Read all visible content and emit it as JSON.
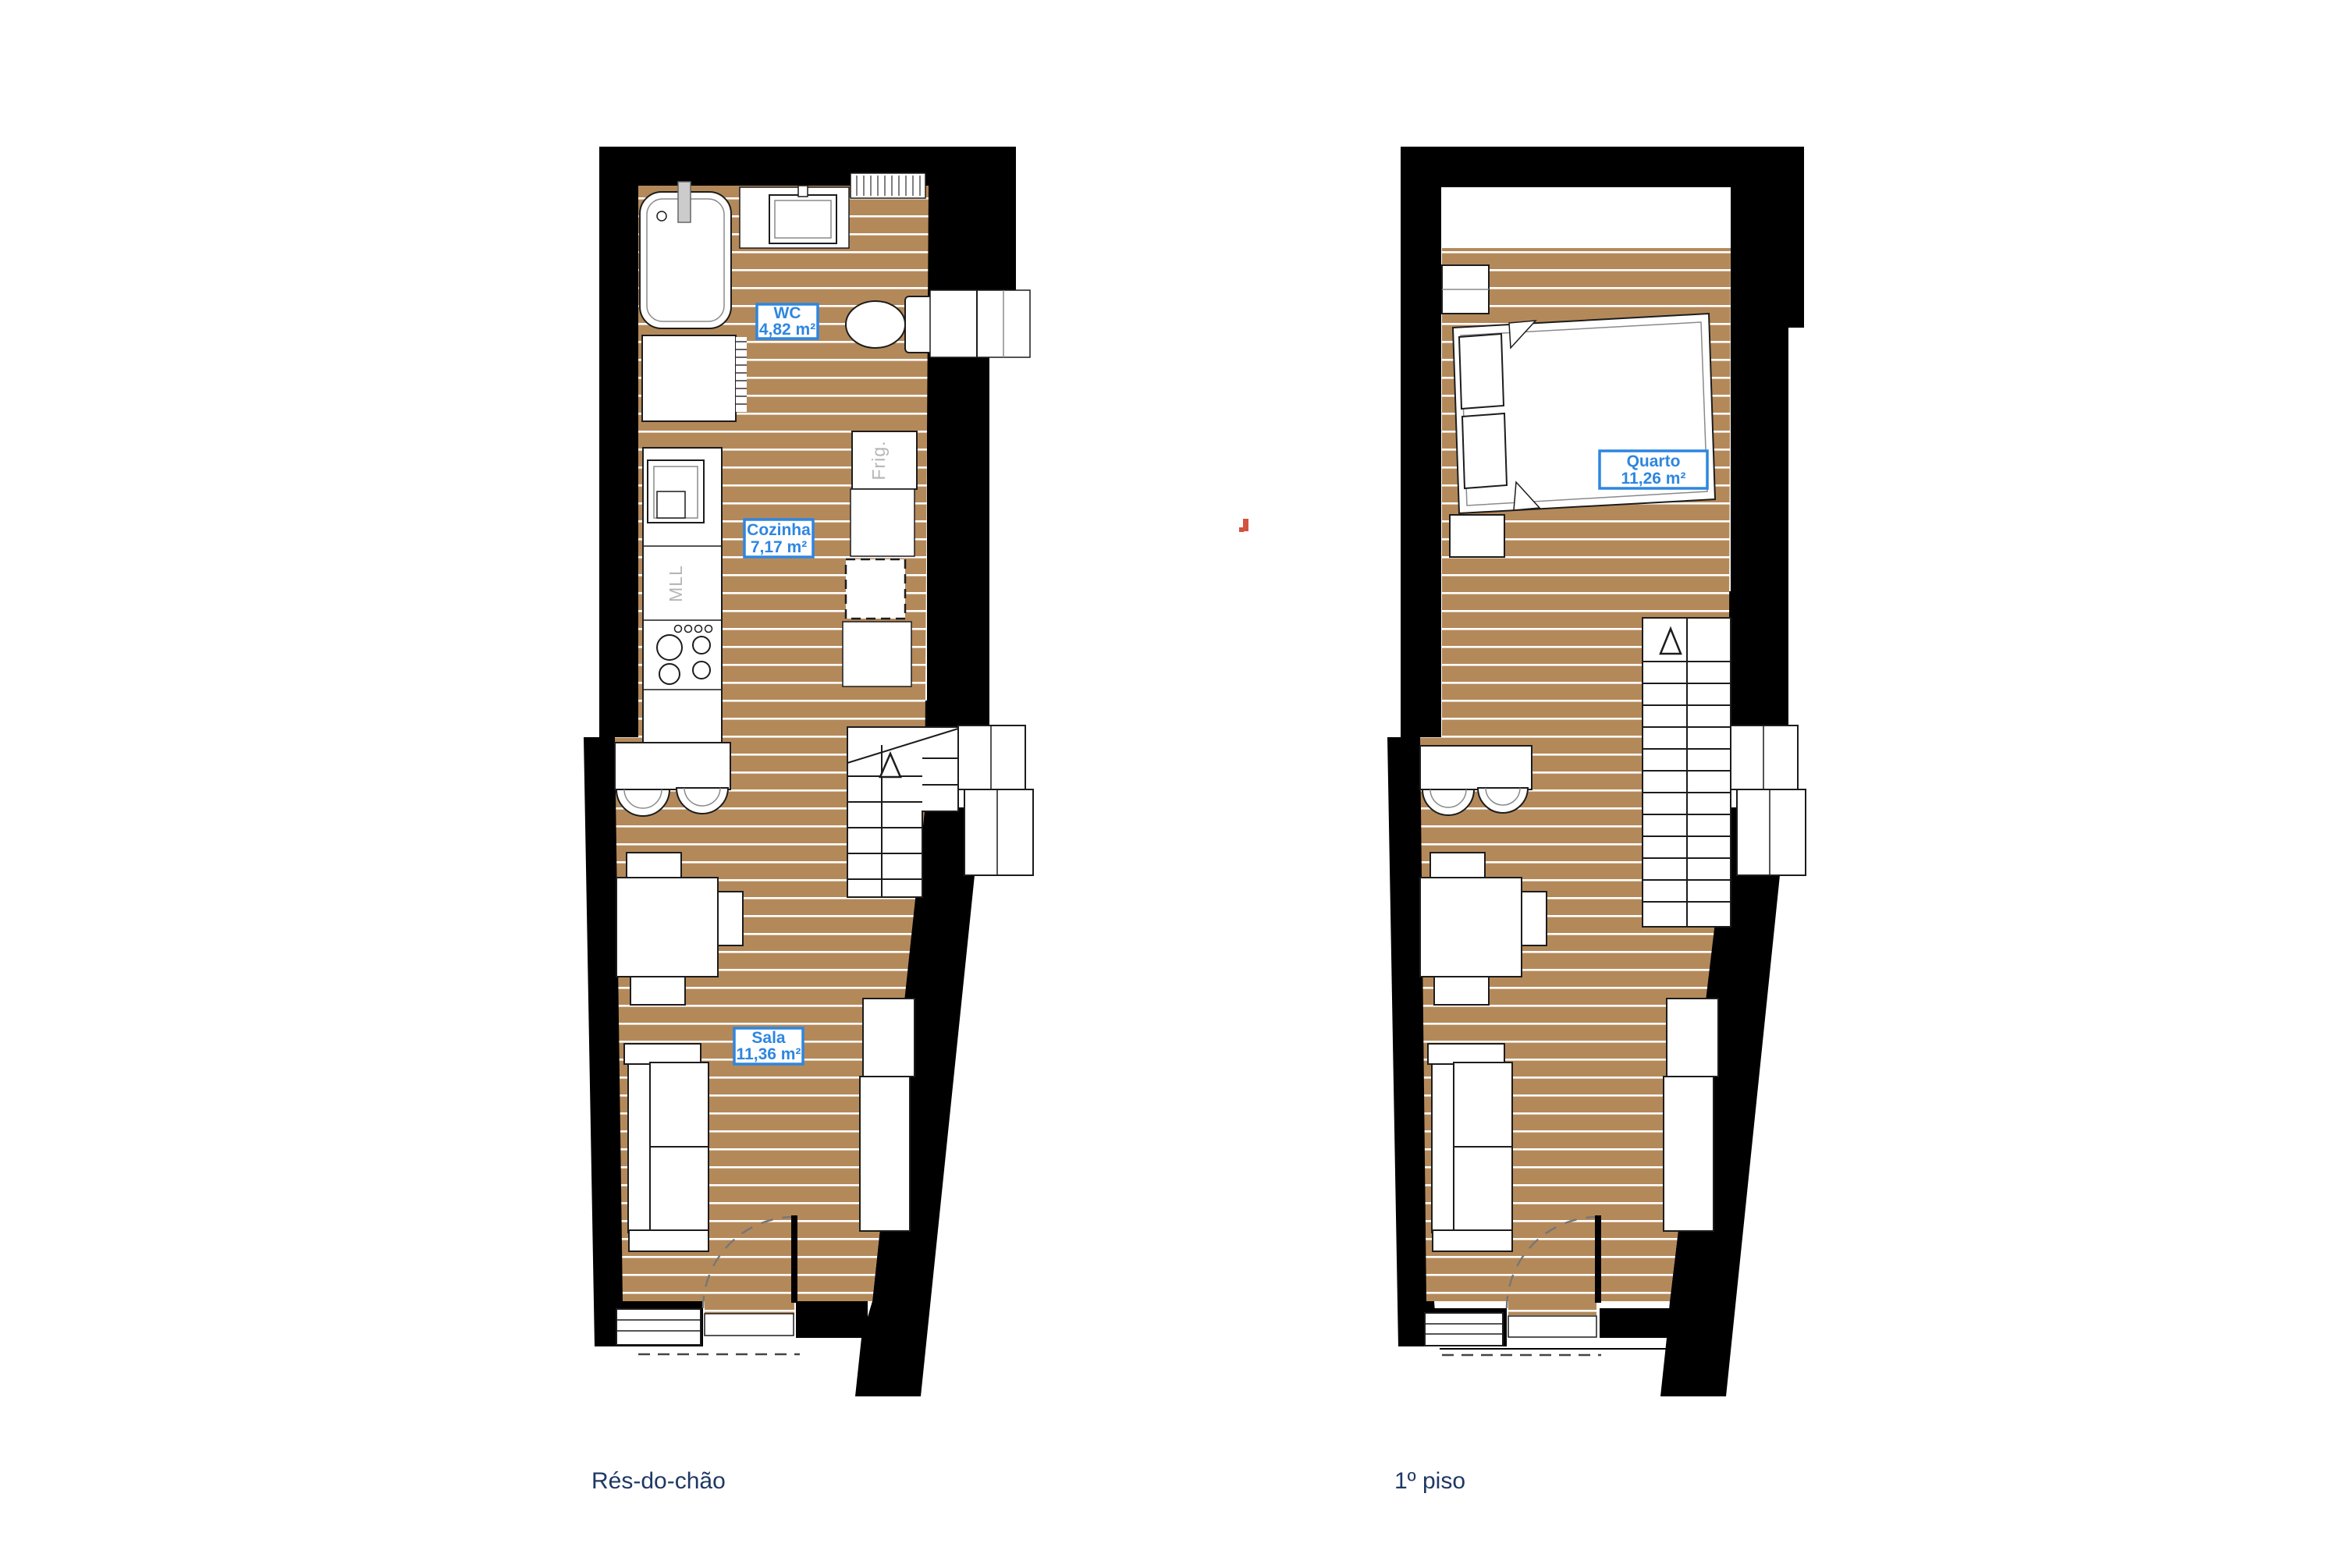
{
  "sheet": {
    "background": "#ffffff",
    "type": "architectural floor plans"
  },
  "colors": {
    "wall_black": "#000000",
    "floor_wood": "#b4895a",
    "plank_line": "#ffffff",
    "room_label_blue": "#2e86e0",
    "caption_navy": "#1f3864",
    "appliance_text_gray": "#b5b5b5",
    "stray_mark_orange": "#d2543f"
  },
  "plans": [
    {
      "caption": "Rés-do-chão",
      "rooms": [
        {
          "name": "WC",
          "area": "4,82 m²"
        },
        {
          "name": "Cozinha",
          "area": "7,17 m²"
        },
        {
          "name": "Sala",
          "area": "11,36 m²"
        }
      ],
      "appliances": {
        "fridge": "Frig.",
        "washer": "MLL"
      }
    },
    {
      "caption": "1º piso",
      "rooms": [
        {
          "name": "Quarto",
          "area": "11,26 m²"
        }
      ]
    }
  ]
}
